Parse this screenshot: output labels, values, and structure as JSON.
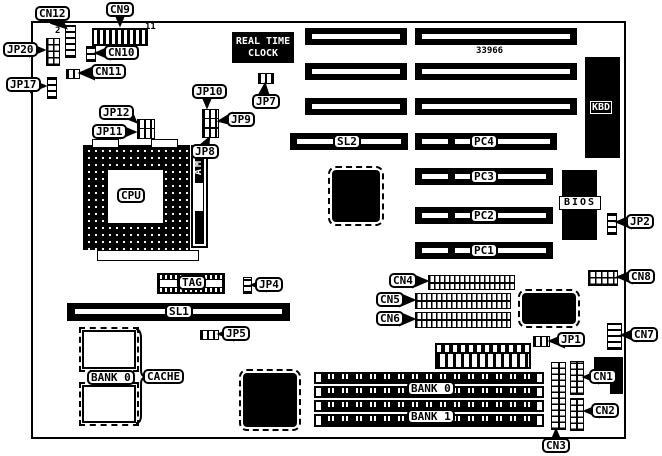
{
  "board": {
    "part_number": "33966",
    "chips": {
      "rtc": "REAL TIME CLOCK",
      "kbd": "KBD",
      "bios": "BIOS",
      "cpu": "CPU",
      "amp": "AMP",
      "tag": "TAG",
      "cache_label": "CACHE",
      "cache_bank": "BANK 0"
    },
    "slots": {
      "sl1": "SL1",
      "sl2": "SL2",
      "pc1": "PC1",
      "pc2": "PC2",
      "pc3": "PC3",
      "pc4": "PC4"
    },
    "memory": {
      "bank0": "BANK 0",
      "bank1": "BANK 1"
    },
    "connectors": {
      "cn1": "CN1",
      "cn2": "CN2",
      "cn3": "CN3",
      "cn4": "CN4",
      "cn5": "CN5",
      "cn6": "CN6",
      "cn7": "CN7",
      "cn8": "CN8",
      "cn9": "CN9",
      "cn10": "CN10",
      "cn11": "CN11",
      "cn12": "CN12"
    },
    "jumpers": {
      "jp1": "JP1",
      "jp2": "JP2",
      "jp4": "JP4",
      "jp5": "JP5",
      "jp7": "JP7",
      "jp8": "JP8",
      "jp9": "JP9",
      "jp10": "JP10",
      "jp11": "JP11",
      "jp12": "JP12",
      "jp17": "JP17",
      "jp20": "JP20"
    },
    "pin_markers": {
      "jp20_pin2": "2",
      "cn9_pin11": "11"
    }
  }
}
